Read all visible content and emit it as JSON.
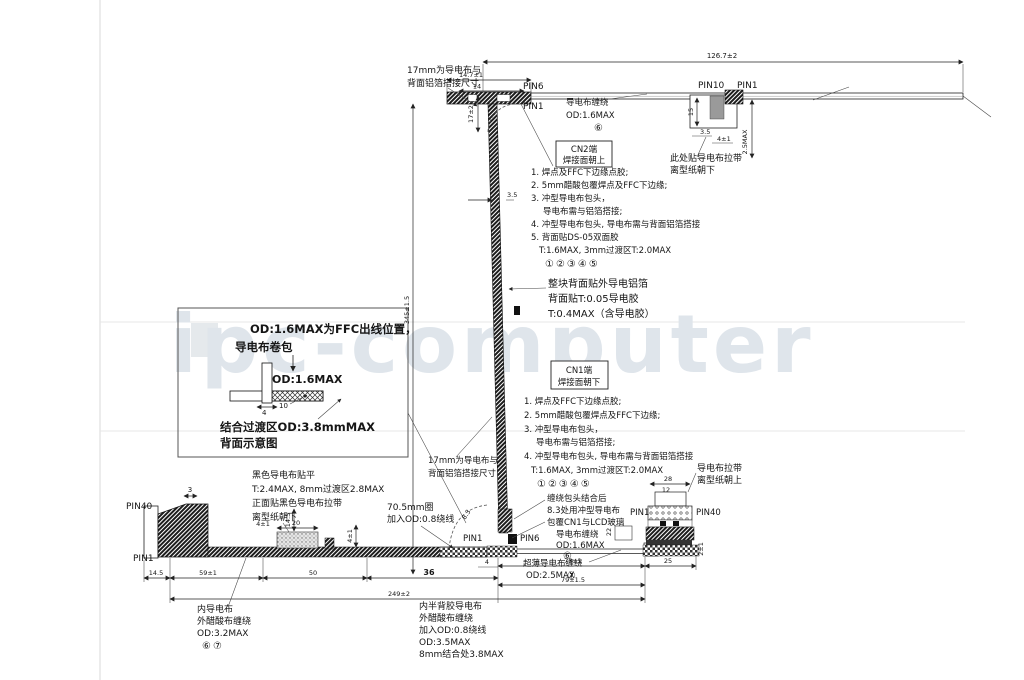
{
  "watermark": "ipc-computer",
  "top": {
    "dims": {
      "overall": "126.7±2",
      "w1": "14.7±1",
      "w2": "14",
      "h": "17±2",
      "t": "3.5",
      "len": "345±1.5",
      "d15": "15",
      "d25max": "2.5MAX",
      "d35": "3.5",
      "d41": "4±1"
    },
    "pin6": "PIN6",
    "pin1_left": "PIN1",
    "pin10": "PIN10",
    "pin1_right": "PIN1",
    "note17": [
      "17mm为导电布与",
      "背面铝箔搭接尺寸"
    ],
    "wrap": [
      "导电布缠绕",
      "OD:1.6MAX"
    ],
    "wrap_mark": "⑥",
    "pull_note": [
      "此处贴导电布拉带",
      "离型纸朝下"
    ]
  },
  "cn2": {
    "box": [
      "CN2端",
      "焊接面朝上"
    ],
    "notes": [
      "1. 焊点及FFC下边缘点胶;",
      "2. 5mm醋酸包覆焊点及FFC下边缘;",
      "3. 冲型导电布包头，",
      "导电布需与铝箔搭接;",
      "4. 冲型导电布包头, 导电布需与背面铝箔搭接",
      "5. 背面贴DS-05双面胶",
      "T:1.6MAX, 3mm过渡区T:2.0MAX"
    ],
    "marks": "①②③④⑤"
  },
  "foil": {
    "lines": [
      "整块背面贴外导电铝箔",
      "背面贴T:0.05导电胶",
      "T:0.4MAX（含导电胶）"
    ]
  },
  "cn1": {
    "box": [
      "CN1端",
      "焊接面朝下"
    ],
    "notes": [
      "1. 焊点及FFC下边缘点胶;",
      "2. 5mm醋酸包覆焊点及FFC下边缘;",
      "3. 冲型导电布包头，",
      "导电布需与铝箔搭接;",
      "4. 冲型导电布包头, 导电布需与背面铝箔搭接",
      "T:1.6MAX, 3mm过渡区T:2.0MAX"
    ],
    "marks": "①②③④⑤",
    "note17": [
      "17mm为导电布与",
      "背面铝箔搭接尺寸"
    ]
  },
  "inset": {
    "title1": "OD:1.6MAX为FFC出线位置，",
    "title2": "导电布卷包",
    "od": "OD:1.6MAX",
    "d4": "4",
    "d10": "10",
    "transition": "结合过渡区OD:3.8mmMAX",
    "caption": "背面示意图"
  },
  "bottom": {
    "pin40_left": "PIN40",
    "pin1_left": "PIN1",
    "pin1_mid": "PIN1",
    "pin6_mid": "PIN6",
    "pin1_right": "PIN1",
    "pin40_right": "PIN40",
    "black_note": [
      "黑色导电布贴平",
      "T:2.4MAX, 8mm过渡区2.8MAX",
      "正面贴黑色导电布拉带",
      "离型纸朝下"
    ],
    "loop_note": [
      "70.5mm圈",
      "加入OD:0.8绕线"
    ],
    "join_note": [
      "缠绕包头结合后",
      "8.3处用冲型导电布",
      "包覆CN1与LCD玻璃"
    ],
    "wrap": [
      "导电布缠绕",
      "OD:1.6MAX"
    ],
    "wrap_mark": "⑥",
    "thin_wrap": [
      "超薄导电布缠绕",
      "OD:2.5MAX"
    ],
    "thin_mark": "⑦",
    "pull_note": [
      "导电布拉带",
      "离型纸朝上"
    ],
    "inner_note": [
      "内导电布",
      "外醋酸布缠绕",
      "OD:3.2MAX"
    ],
    "inner_marks": "⑥⑦",
    "half_note": [
      "内半背胶导电布",
      "外醋酸布缠绕",
      "加入OD:0.8绕线",
      "OD:3.5MAX",
      "8mm结合处3.8MAX"
    ],
    "dims": {
      "d3": "3",
      "d145a": "14.5",
      "d145b": "14.5",
      "d20": "20",
      "d41a": "4±1",
      "d41b": "4±1",
      "d59": "59±1",
      "d50": "50",
      "d36": "36",
      "d4": "4",
      "d73": "73±1",
      "d25": "25",
      "d79": "79±1.5",
      "d249": "249±2",
      "d28": "28",
      "d12": "12",
      "d22": "22",
      "d21": "2±1",
      "r83": "8.3"
    }
  }
}
